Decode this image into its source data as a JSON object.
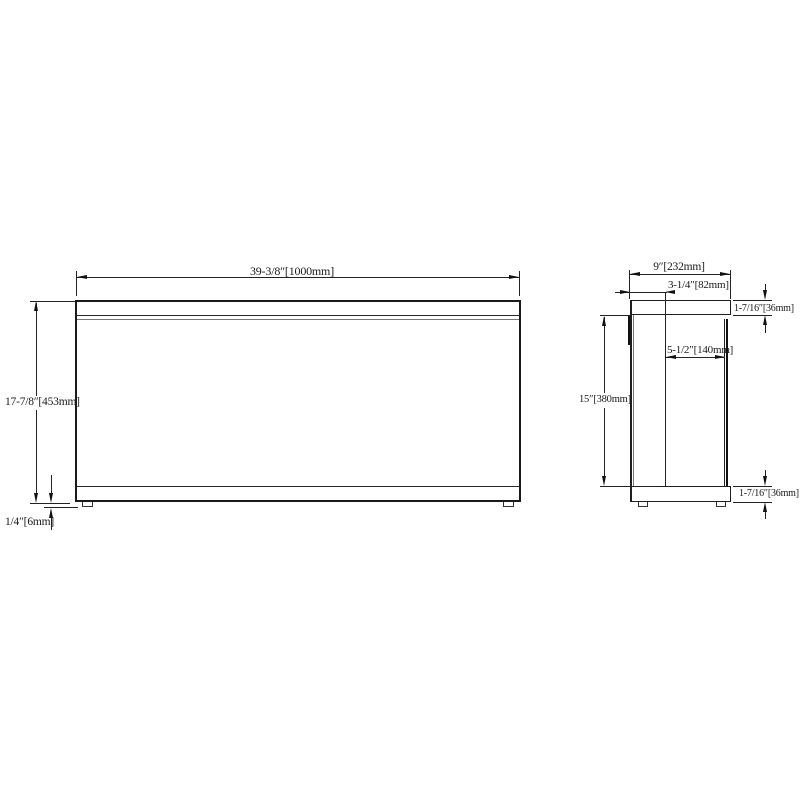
{
  "colors": {
    "line": "#1a1a1a",
    "background": "#ffffff"
  },
  "front_view": {
    "width": "39-3/8″[1000mm]",
    "height": "17-7/8″[453mm]",
    "foot_height": "1/4″[6mm]"
  },
  "side_view": {
    "depth": "9″[232mm]",
    "top_back_offset": "3-1/4″[82mm]",
    "lid_depth": "5-1/2″[140mm]",
    "inner_height": "15″[380mm]",
    "top_panel_thickness": "1-7/16″[36mm]",
    "bottom_panel_thickness": "1-7/16″[36mm]"
  }
}
